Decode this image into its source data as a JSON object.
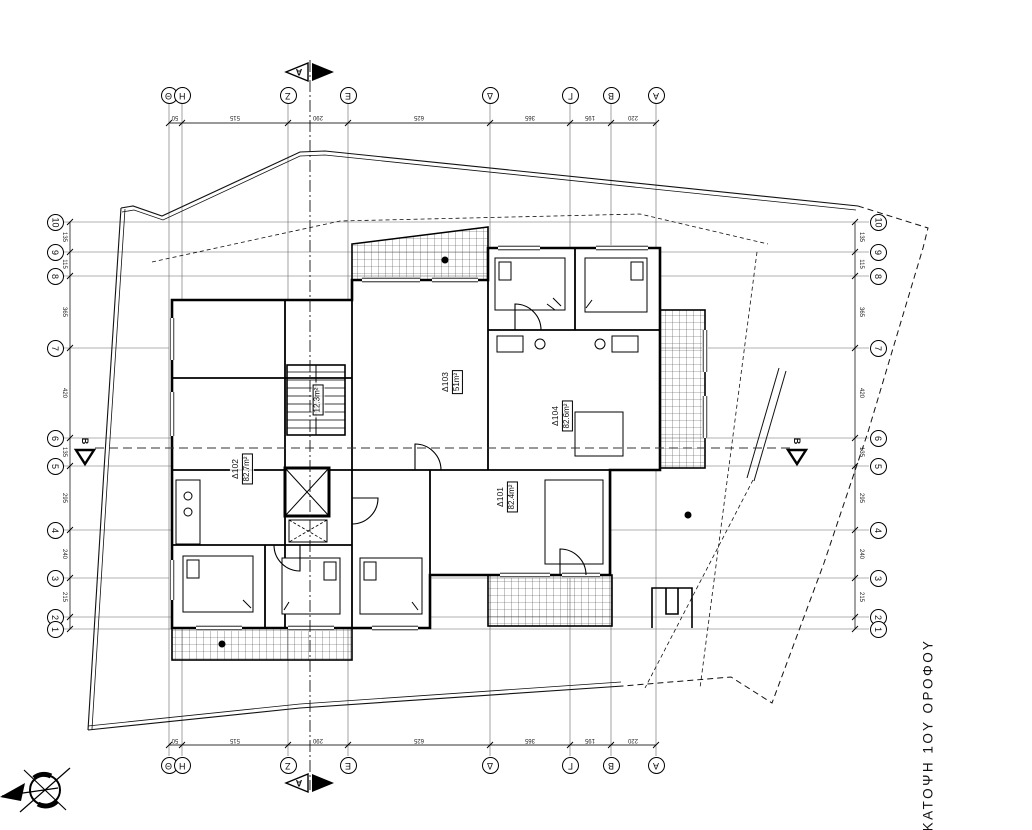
{
  "drawing_title": "ΚΑΤΟΨΗ 1ΟΥ ΟΡΟΦΟΥ",
  "grid": {
    "col_labels": [
      "Θ",
      "Η",
      "Ζ",
      "Ε",
      "Δ",
      "Γ",
      "Β",
      "Α"
    ],
    "row_labels": [
      "10",
      "9",
      "8",
      "7",
      "6",
      "5",
      "4",
      "3",
      "2",
      "1"
    ],
    "col_dims": [
      "50",
      "515",
      "290",
      "625",
      "365",
      "195",
      "220"
    ],
    "row_dims": [
      "135",
      "115",
      "365",
      "420",
      "135",
      "295",
      "240",
      "215",
      "50"
    ]
  },
  "sections": {
    "a": "A",
    "b": "B"
  },
  "apartments": [
    {
      "id": "Δ101",
      "area": "82.4m²"
    },
    {
      "id": "Δ102",
      "area": "82.7m²"
    },
    {
      "id": "Δ103",
      "area": "51m²"
    },
    {
      "id": "Δ104",
      "area": "82.6m²"
    }
  ],
  "stairwell": {
    "area": "12.3m²"
  },
  "colors": {
    "ink": "#111111",
    "paper": "#ffffff"
  }
}
